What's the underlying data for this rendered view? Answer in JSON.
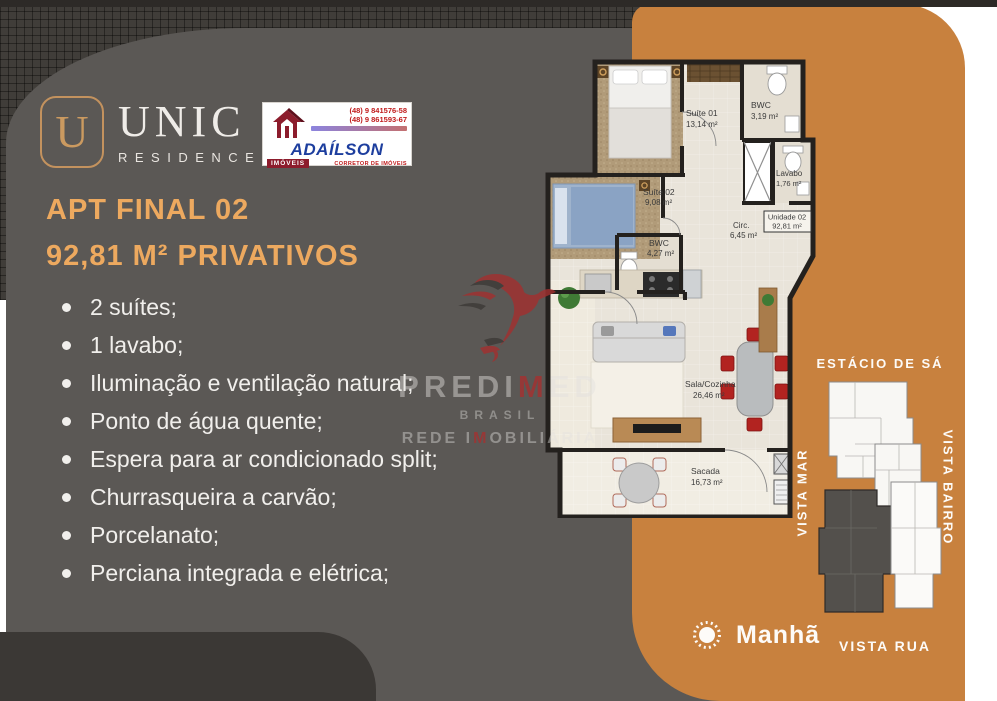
{
  "brand": {
    "unic_initial": "U",
    "unic_name": "UNIC",
    "unic_sub": "RESIDENCE",
    "agent_name": "ADAÍLSON",
    "agent_tag": "IMÓVEIS",
    "agent_role": "CORRETOR DE IMÓVEIS",
    "agent_phone1": "(48) 9 841576-58",
    "agent_phone2": "(48) 9 861593-67"
  },
  "headline": {
    "line1": "APT FINAL 02",
    "line2": "92,81 M² PRIVATIVOS"
  },
  "features": [
    "2 suítes;",
    "1 lavabo;",
    "Iluminação e ventilação natural;",
    "Ponto de água quente;",
    "Espera para ar condicionado split;",
    "Churrasqueira a carvão;",
    "Porcelanato;",
    "Perciana integrada e elétrica;"
  ],
  "floorplan": {
    "rooms": [
      {
        "name": "Suíte 01",
        "area": "13,14 m²"
      },
      {
        "name": "BWC",
        "area": "3,19 m²"
      },
      {
        "name": "Lavabo",
        "area": "1,76 m²"
      },
      {
        "name": "Unidade 02",
        "area": "92,81 m²"
      },
      {
        "name": "Circ.",
        "area": "6,45 m²"
      },
      {
        "name": "Suíte 02",
        "area": "9,08 m²"
      },
      {
        "name": "BWC",
        "area": "4,27 m²"
      },
      {
        "name": "Sala/Cozinha",
        "area": "26,46 m²"
      },
      {
        "name": "Sacada",
        "area": "16,73 m²"
      }
    ]
  },
  "siteplan": {
    "top": "ESTÁCIO DE SÁ",
    "left": "VISTA MAR",
    "right": "VISTA BAIRRO",
    "bottom": "VISTA RUA",
    "sun_label": "Manhã"
  },
  "watermark": {
    "part1": "PREDI",
    "part1_red": "M",
    "part1_end": "ED",
    "line2": "BRASIL",
    "part3": "REDE I",
    "part3_red": "M",
    "part3_end": "OBILIÁRIA"
  },
  "colors": {
    "orange": "#c8813e",
    "accent": "#eda95f",
    "panel_gray": "#5b5855"
  }
}
